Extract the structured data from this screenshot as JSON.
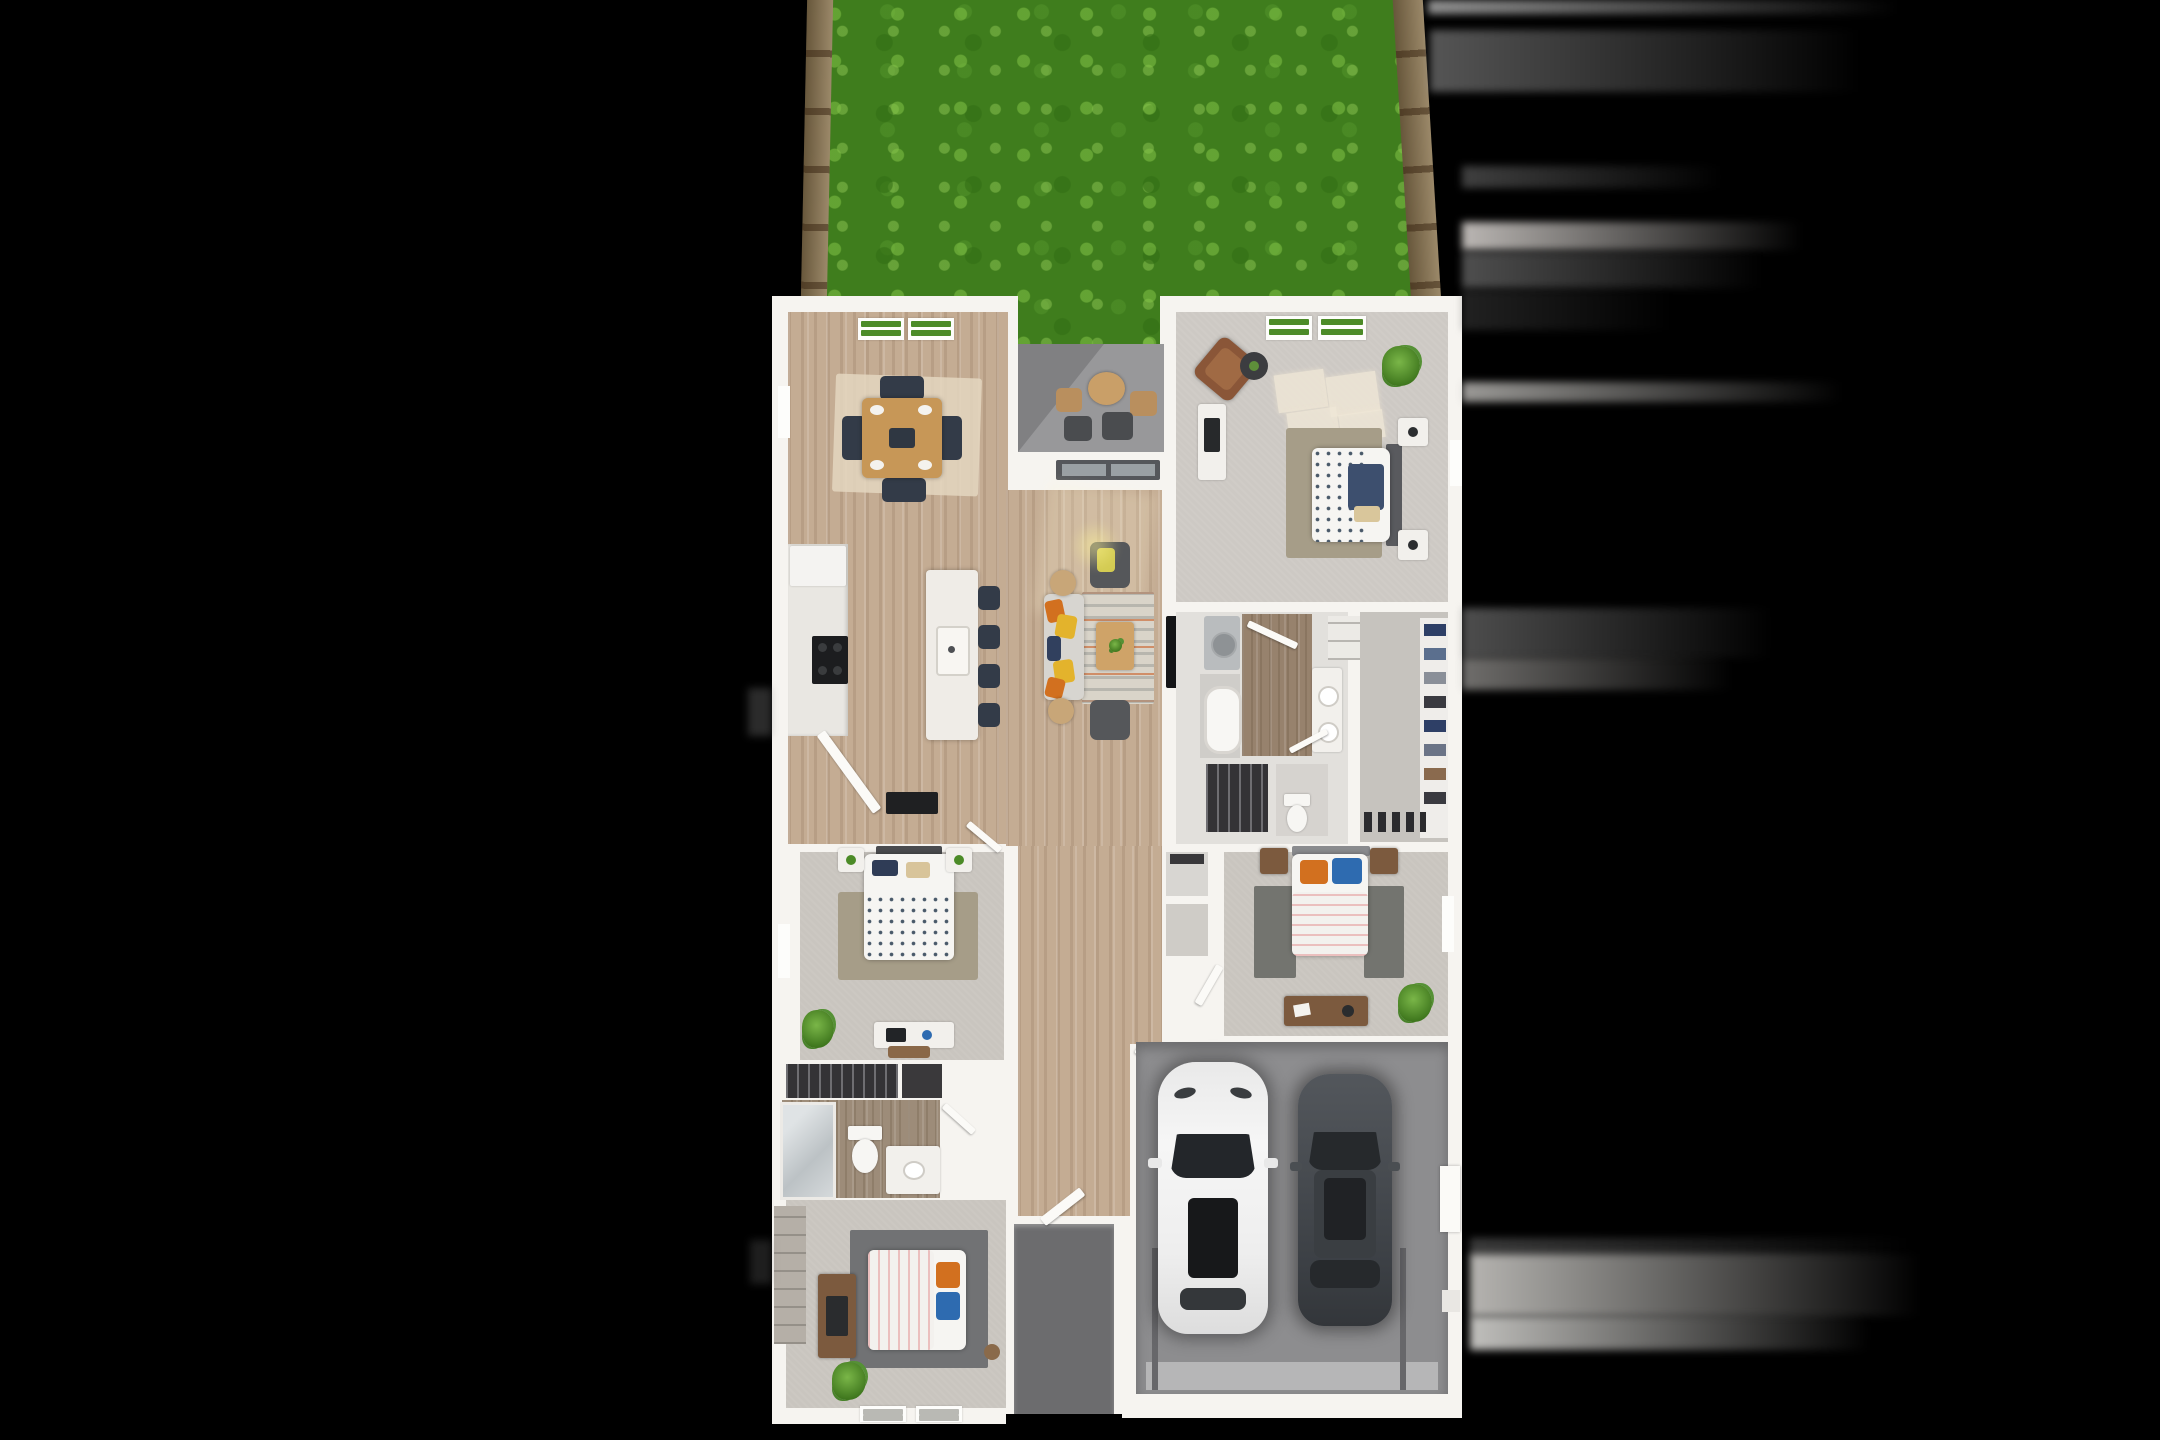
{
  "scene": {
    "kind": "3d-rendered-floor-plan-top-view",
    "background": "black",
    "stats": {
      "bedrooms": 4,
      "bathrooms": 2,
      "garage_cars": 2,
      "patio": 1,
      "backyard": 1
    }
  },
  "palette": {
    "grass": "#3f7d1d",
    "grassLight": "#7ab648",
    "fence": "#8a744f",
    "wall": "#f6f4f0",
    "wood": "#c4ac93",
    "tileBrown": "#97826d",
    "carpet": "#c9c5bf",
    "carpetPrimary": "#cdc9c4",
    "patio": "#98989a",
    "porch": "#6c6c6e",
    "garage": "#8d8d8f",
    "closetDark": "#343336",
    "rugOlive": "#a69d88",
    "rugBeige": "#e4d6bf",
    "navy": "#333b48",
    "orange": "#d2701f",
    "yellow": "#d3cb52",
    "blue": "#2e6bb0",
    "sofa": "#d7d5d0",
    "charcoal": "#55575a",
    "woodFurniture": "#c79757",
    "dresserBrown": "#7c5a3e",
    "windowGreen": "#4c8b27",
    "carWhite": "#f2f2f2",
    "carDark": "#474b50"
  },
  "rooms": [
    {
      "id": "backyard",
      "furniture": [
        "lawn",
        "fence-left",
        "fence-right"
      ]
    },
    {
      "id": "dining-room",
      "furniture": [
        "dining-table",
        "four-chairs",
        "area-rug",
        "windows"
      ]
    },
    {
      "id": "covered-patio",
      "furniture": [
        "round-table",
        "four-outdoor-chairs"
      ]
    },
    {
      "id": "kitchen",
      "furniture": [
        "counter",
        "range",
        "refrigerator",
        "island",
        "sink",
        "four-stools"
      ]
    },
    {
      "id": "living-room",
      "furniture": [
        "sofa",
        "two-armchairs",
        "striped-rug",
        "coffee-table",
        "side-tables",
        "tv"
      ]
    },
    {
      "id": "primary-bedroom",
      "furniture": [
        "bed",
        "headboard",
        "nightstands",
        "armchair",
        "side-table",
        "dresser",
        "plant",
        "rug",
        "windows"
      ]
    },
    {
      "id": "primary-bathroom",
      "furniture": [
        "washer",
        "bathtub",
        "double-vanity",
        "toilet",
        "linen-closet",
        "hanging-closet"
      ]
    },
    {
      "id": "walk-in-closet",
      "furniture": [
        "clothes-shelves",
        "shoe-row"
      ]
    },
    {
      "id": "bedroom-2",
      "furniture": [
        "bed",
        "nightstands",
        "rug",
        "desk",
        "plant",
        "closet"
      ]
    },
    {
      "id": "bedroom-3",
      "furniture": [
        "bed",
        "nightstands",
        "rugs",
        "dresser",
        "plant"
      ]
    },
    {
      "id": "bedroom-4",
      "furniture": [
        "bed",
        "dresser",
        "rug",
        "plant",
        "closet",
        "windows"
      ]
    },
    {
      "id": "hall-bathroom",
      "furniture": [
        "shower",
        "toilet",
        "vanity"
      ]
    },
    {
      "id": "entry",
      "furniture": [
        "front-door",
        "porch"
      ]
    },
    {
      "id": "garage",
      "furniture": [
        "white-suv",
        "dark-sedan",
        "garage-door",
        "side-door"
      ]
    }
  ]
}
